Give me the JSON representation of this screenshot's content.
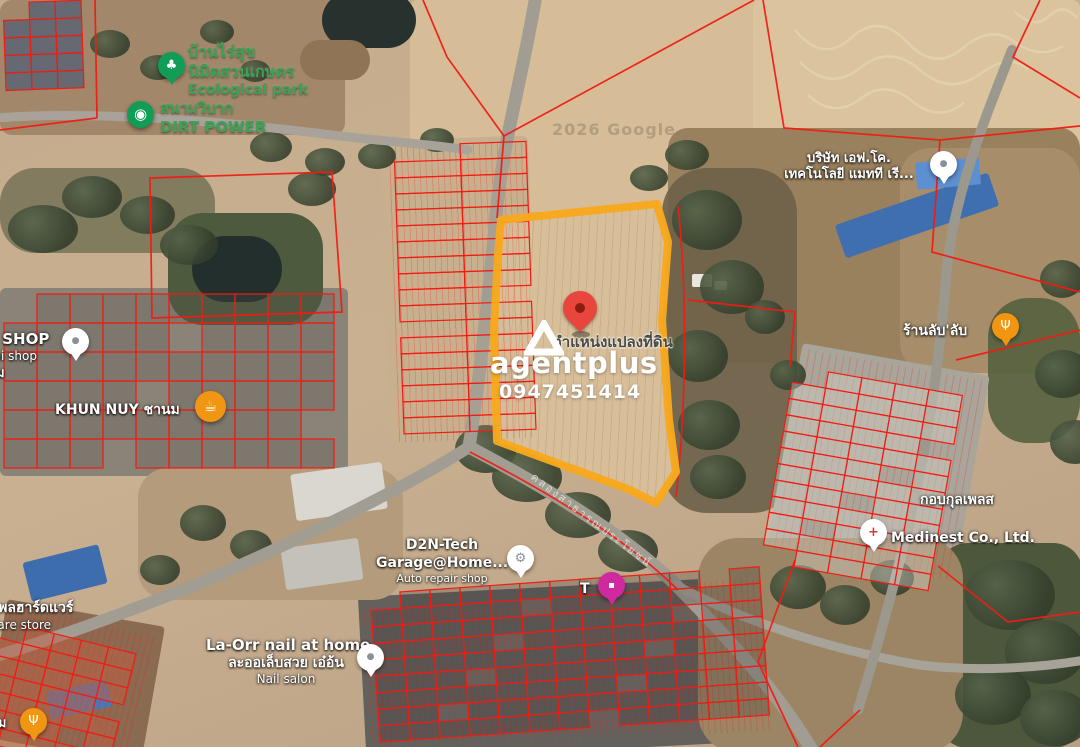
{
  "map": {
    "google_watermark": "2026 Google",
    "road_label": "คลองสาธารณประโยชน์"
  },
  "watermark": {
    "brand": "agentplus",
    "phone": "0947451414"
  },
  "plot": {
    "label": "ตำแหน่งแปลงที่ดิน"
  },
  "colors": {
    "parcel_red": "#f21b12",
    "plot_orange": "#f7a81d",
    "pin_red": "#e8453c",
    "poi_green": "#129d57",
    "green_label": "#3fa152",
    "poi_orange": "#f19612",
    "poi_pink": "#d0289f"
  },
  "pois": {
    "ecological_park": {
      "name_th1": "บ้านไร่สุข",
      "name_th2": "นิมิตสวนเกษตร",
      "name_en": "Ecological park",
      "glyph": "♣"
    },
    "dirt_power": {
      "name_th": "สนามวิบาก",
      "name_en": "DIRT POWER",
      "glyph": "◉"
    },
    "p_shop": {
      "name": "P SHOP",
      "sub": "pai shop",
      "partial": "ม",
      "glyph": "●"
    },
    "khun_nuy": {
      "name": "KHUN NUY ชานม",
      "glyph": "☕"
    },
    "fco_company": {
      "line1": "บริษัท เอฟ.โค.",
      "line2": "เทคโนโลยี แมทที เรี...",
      "glyph": "●"
    },
    "ran_lub": {
      "name": "ร้านลับ'ลับ",
      "glyph": "Ψ"
    },
    "kobkul_place": {
      "name": "กอบกุลเพลส"
    },
    "medinest": {
      "name": "Medinest Co., Ltd.",
      "glyph": "+"
    },
    "d2n_tech": {
      "line1": "D2N-Tech",
      "line2": "Garage@Home...",
      "line3": "Auto repair shop",
      "glyph": "⚙"
    },
    "t_store": {
      "name": "T",
      "glyph": "▪"
    },
    "la_orr": {
      "line1": "La-Orr nail at home",
      "line2": "ละออเล็บสวย เอ๋อ้น",
      "line3": "Nail salon",
      "glyph": "●"
    },
    "hardware_store": {
      "line1": "ธนพลฮาร์ดแวร์",
      "line2": "dware store"
    },
    "im_restaurant": {
      "name": "อิ่ม",
      "glyph": "Ψ"
    }
  }
}
